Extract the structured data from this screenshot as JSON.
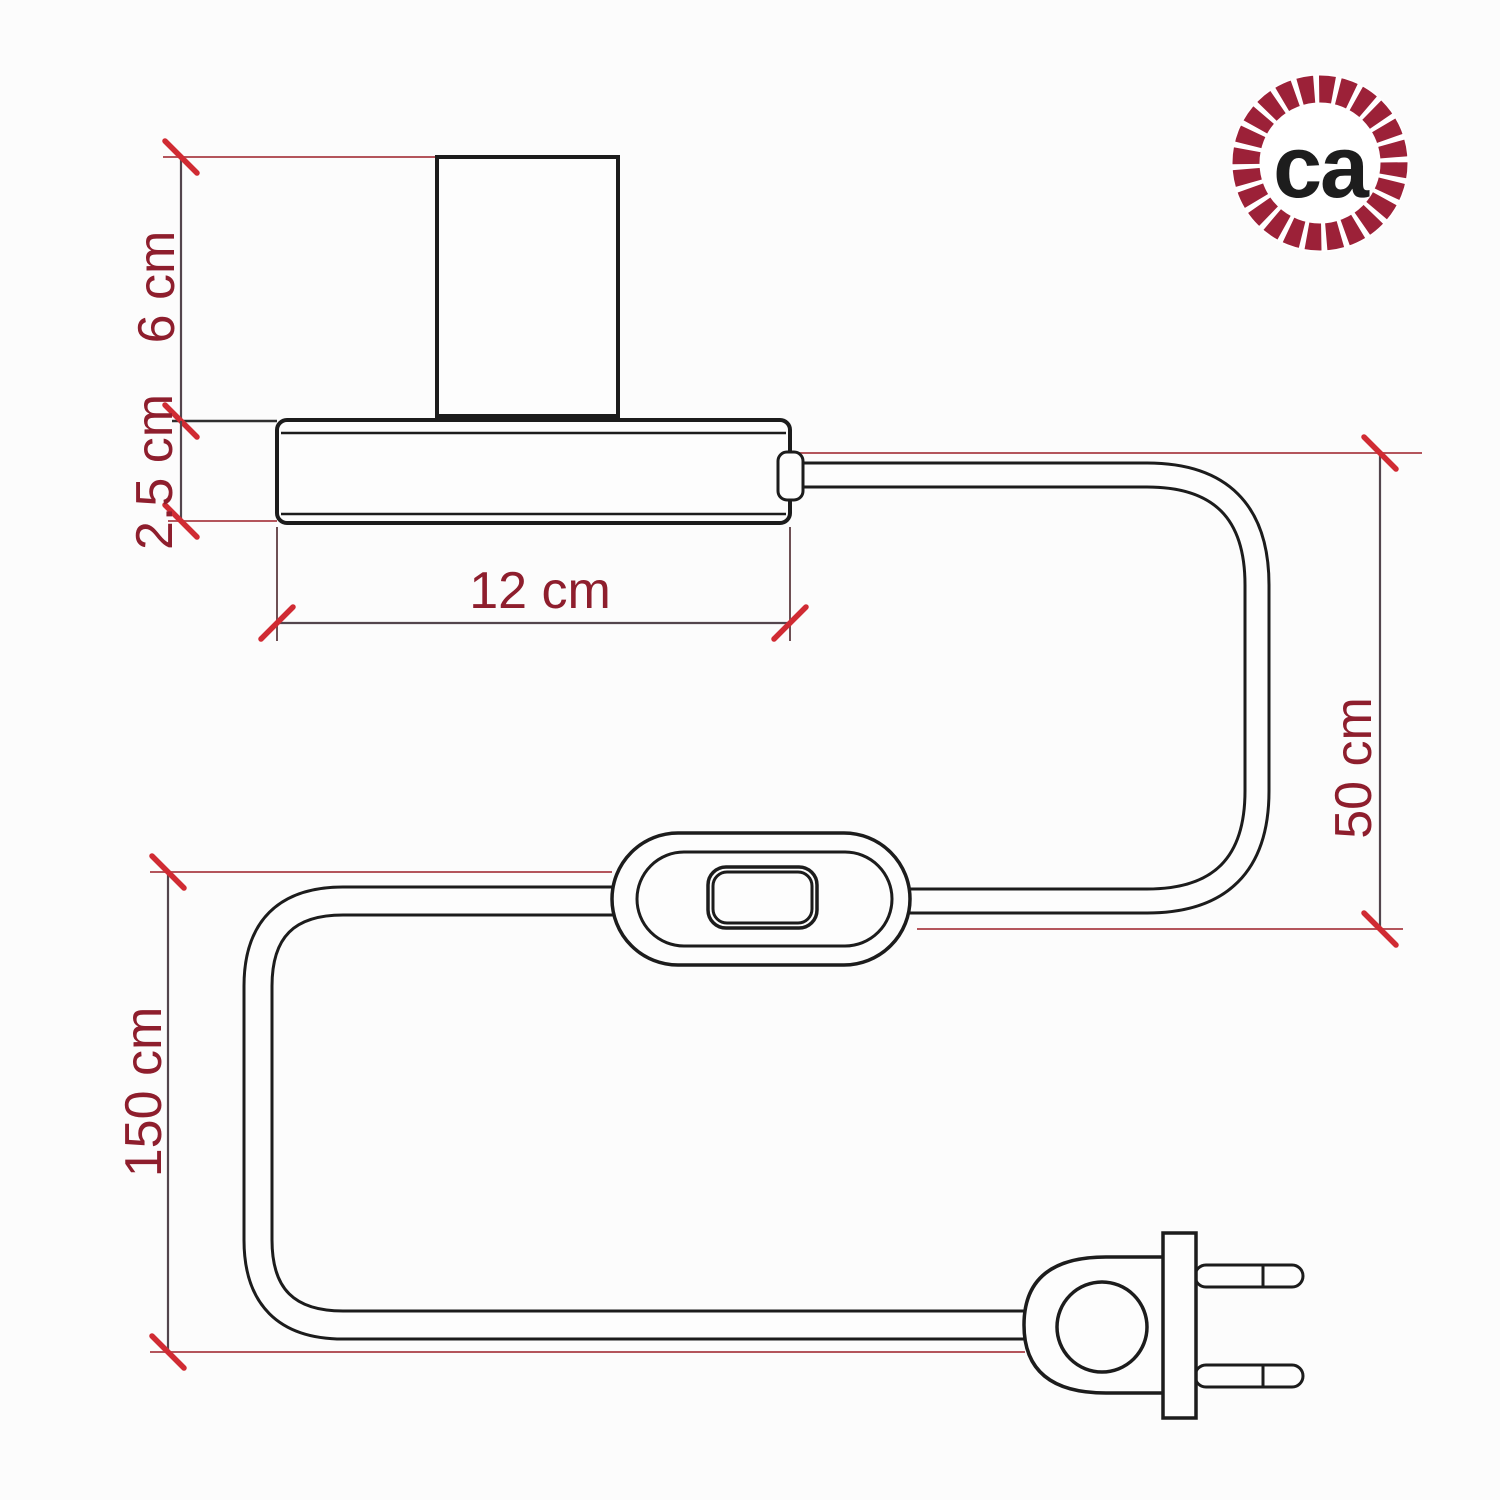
{
  "diagram": {
    "type": "technical-dimension-drawing",
    "subject": "table lamp with inline switch and two-prong plug"
  },
  "dimensions": {
    "socket_height": "6 cm",
    "base_height": "2.5 cm",
    "base_width": "12 cm",
    "lamp_to_switch_cable": "50 cm",
    "total_cable": "150 cm"
  },
  "logo": {
    "text": "ca",
    "ring_color": "#9c2138",
    "text_color": "#1d1d1d"
  },
  "colors": {
    "background": "#fcfcfc",
    "drawing_ink": "#1c1c1c",
    "dimension_line": "#53454d",
    "extension_line": "#b4555c",
    "tick_red": "#d02b33",
    "label_red": "#8e1e2d"
  }
}
